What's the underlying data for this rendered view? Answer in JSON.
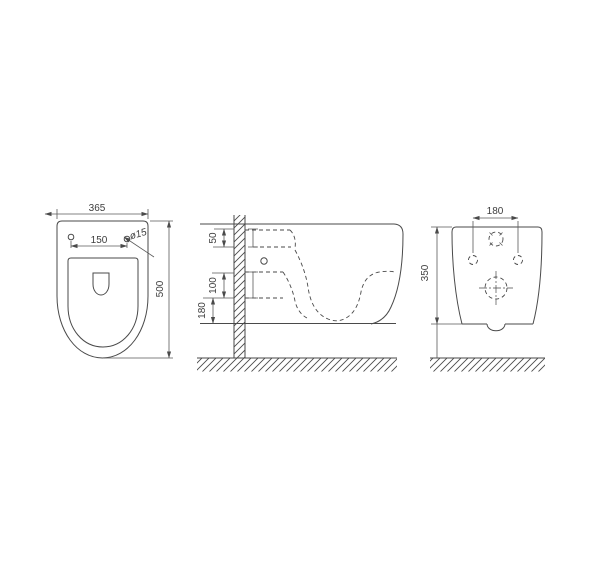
{
  "drawing": {
    "type": "technical-dimension-drawing",
    "subject": "wall-hung toilet, three orthographic views"
  },
  "colors": {
    "background": "#ffffff",
    "line": "#4a4a4a",
    "dimension_text": "#3d3d3d"
  },
  "views": {
    "plan": {
      "width": "365",
      "depth": "500",
      "hole_spacing": "150",
      "hole_diameter": "ø15"
    },
    "side": {
      "inlet_offset": "50",
      "outlet_offset": "100",
      "outlet_height": "180"
    },
    "rear": {
      "bolt_spacing": "180",
      "body_height": "350"
    }
  }
}
